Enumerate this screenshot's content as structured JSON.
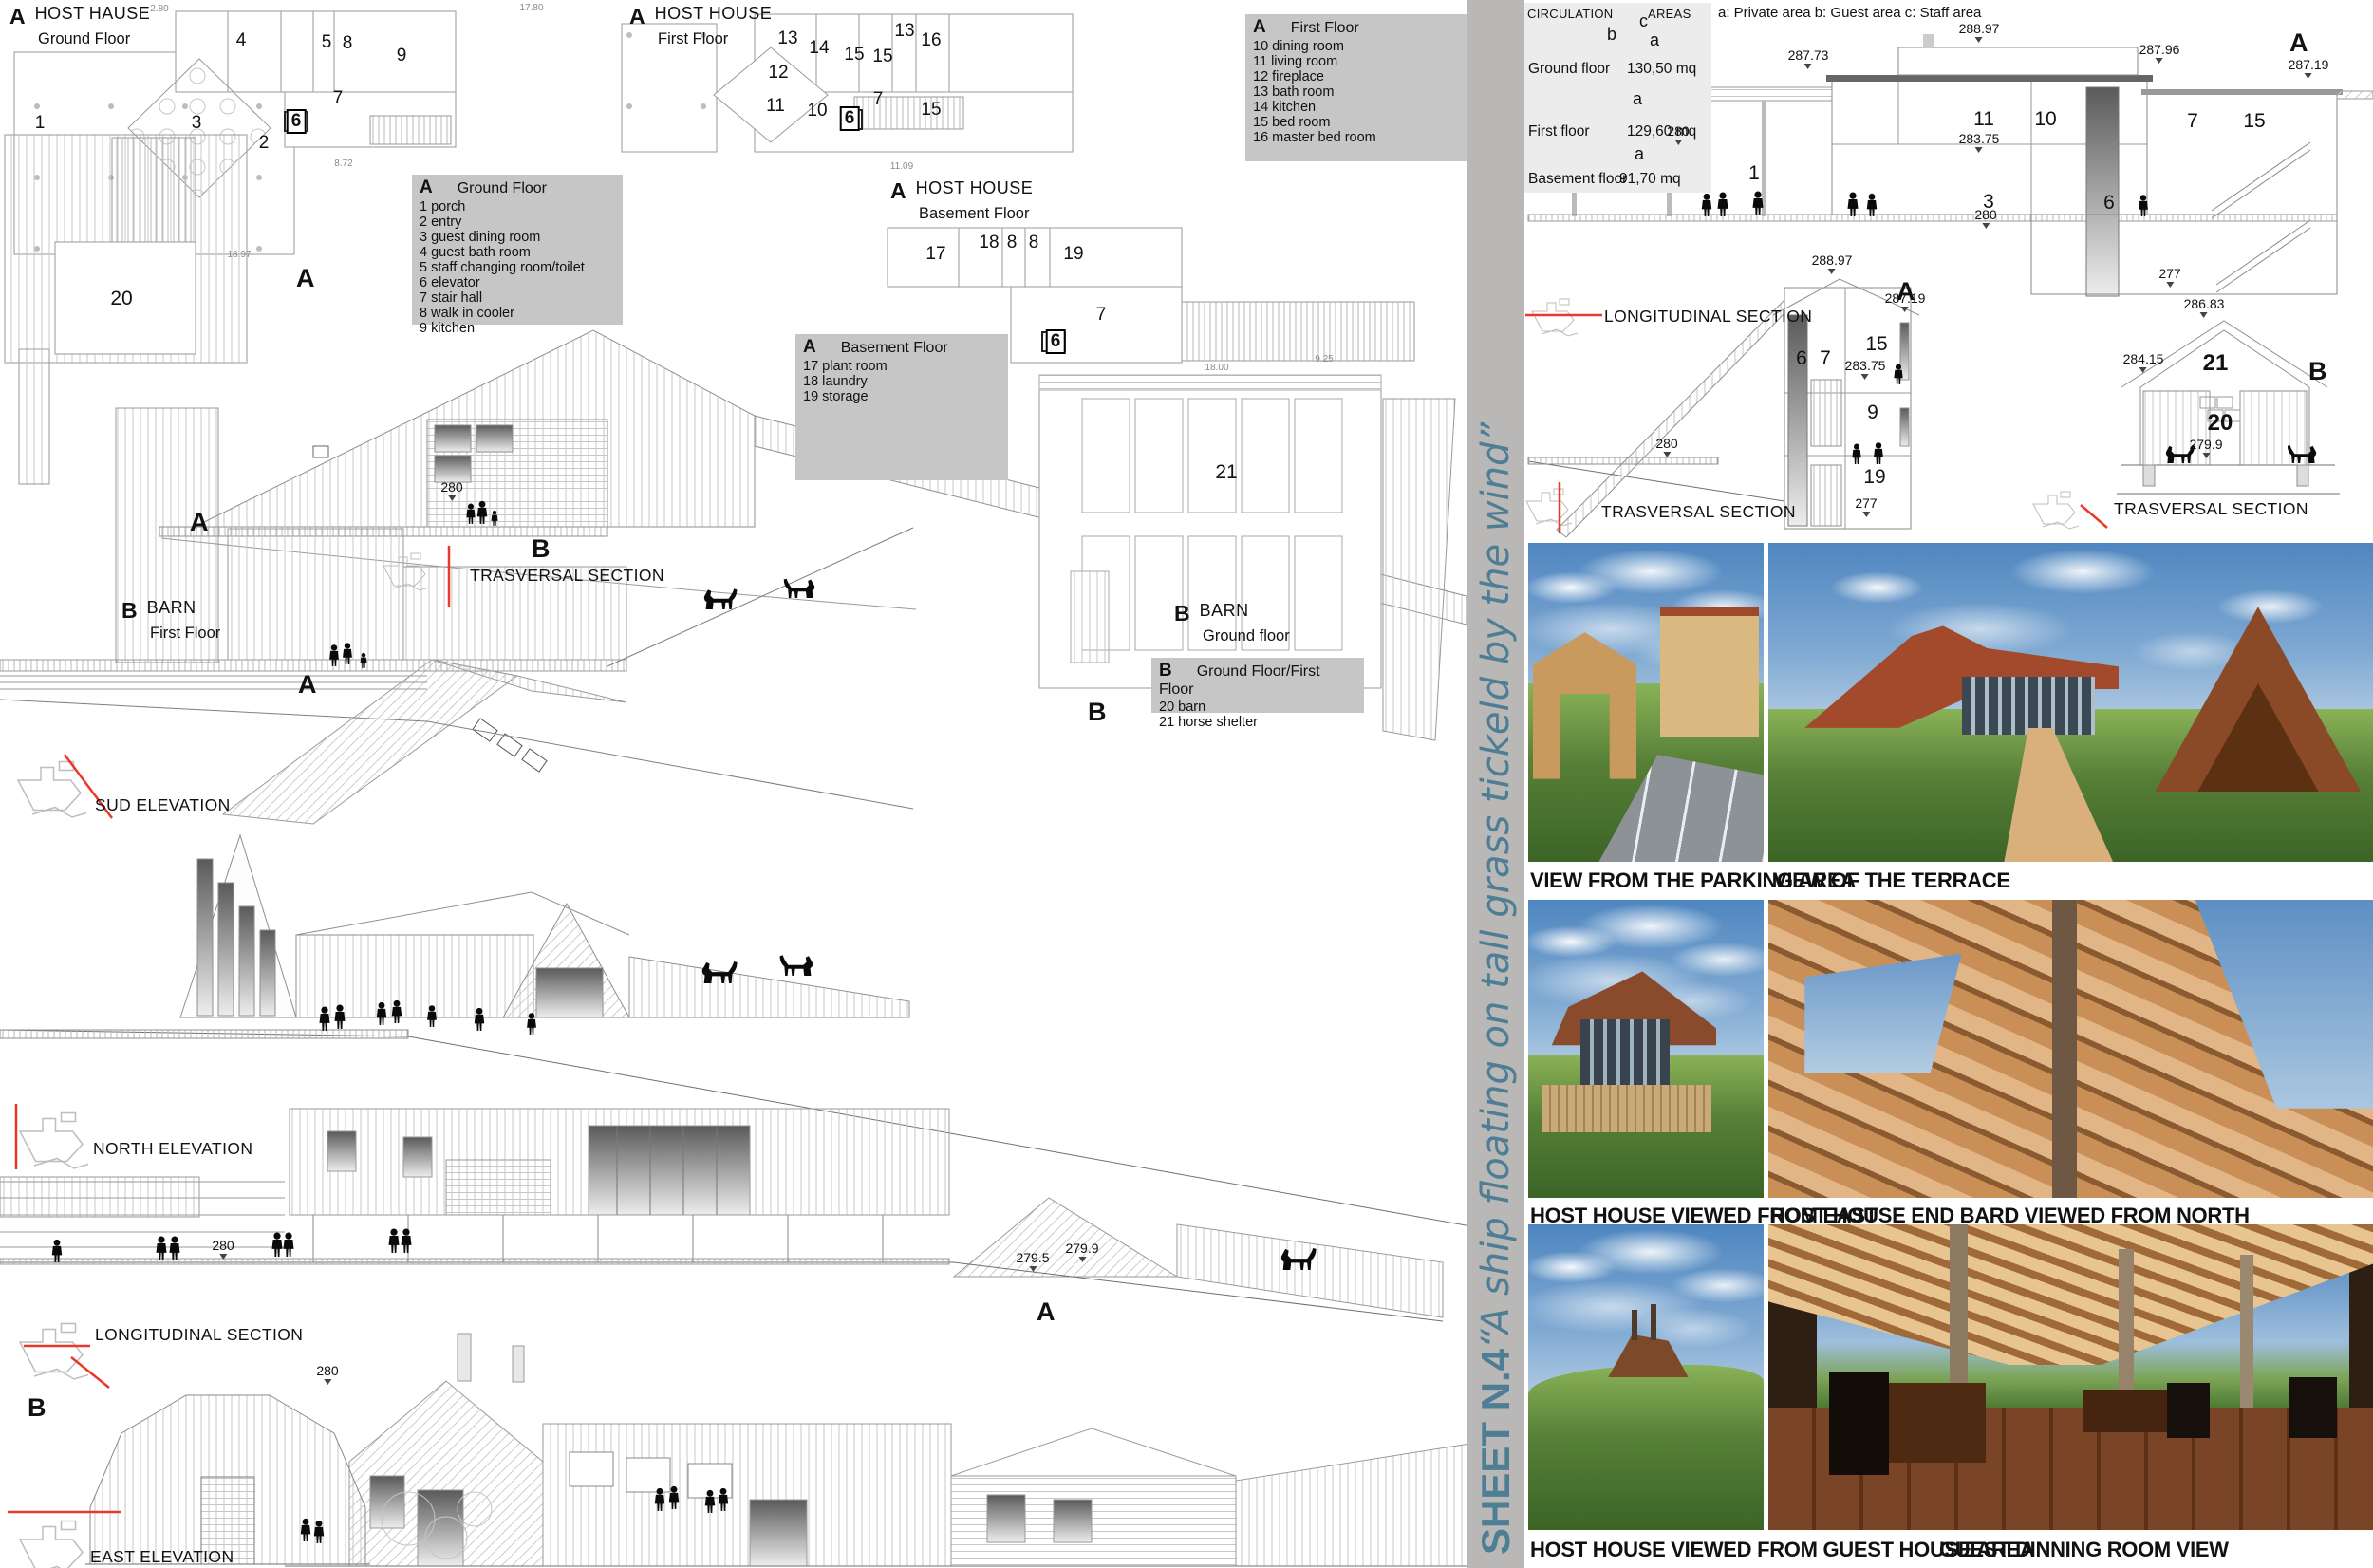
{
  "banner": {
    "sheet_no": "SHEET N.4",
    "quote": "“A ship floating on tall grass tickeld by the wind”"
  },
  "titles": {
    "ground": {
      "marker": "A",
      "name": "HOST HAUSE",
      "floor": "Ground Floor"
    },
    "first": {
      "marker": "A",
      "name": "HOST HOUSE",
      "floor": "First Floor"
    },
    "basement": {
      "marker": "A",
      "name": "HOST HOUSE",
      "floor": "Basement Floor"
    },
    "barn_first": {
      "marker": "B",
      "name": "BARN",
      "floor": "First Floor"
    },
    "barn_ground": {
      "marker": "B",
      "name": "BARN",
      "floor": "Ground floor"
    }
  },
  "legends": {
    "ground": {
      "marker": "A",
      "title": "Ground Floor",
      "items": [
        "1  porch",
        "2 entry",
        "3 guest dining room",
        "4 guest bath room",
        "5 staff changing room/toilet",
        "6 elevator",
        "7 stair hall",
        "8 walk in cooler",
        "9 kitchen"
      ]
    },
    "first": {
      "marker": "A",
      "title": "First Floor",
      "items": [
        "10 dining room",
        "11 living room",
        "12 fireplace",
        "13 bath room",
        "14 kitchen",
        "15 bed room",
        "16 master bed room"
      ]
    },
    "basement": {
      "marker": "A",
      "title": "Basement Floor",
      "items": [
        "17 plant room",
        "18 laundry",
        "19 storage"
      ]
    },
    "barn": {
      "marker": "B",
      "title": "Ground Floor/First Floor",
      "items": [
        "20 barn",
        "21 horse shelter"
      ]
    }
  },
  "areas_panel": {
    "header_circulation": "CIRCULATION",
    "header_areas": "AREAS",
    "zones_note": "a: Private area b: Guest area c: Staff area",
    "rows": [
      {
        "label": "Ground floor",
        "value": "130,50 mq"
      },
      {
        "label": "First floor",
        "value": "129,60 mq"
      },
      {
        "label": "Basement floor",
        "value": "91,70 mq"
      }
    ],
    "letters": [
      "b",
      "c",
      "a",
      "a",
      "a"
    ]
  },
  "section_labels": {
    "trasversal_left": "TRASVERSAL SECTION",
    "sud": "SUD ELEVATION",
    "north": "NORTH ELEVATION",
    "longitudinal_left": "LONGITUDINAL SECTION",
    "east": "EAST ELEVATION",
    "longitudinal_right": "LONGITUDINAL SECTION",
    "trasversal_house": "TRASVERSAL SECTION",
    "trasversal_barn": "TRASVERSAL SECTION"
  },
  "markers": {
    "a": "A",
    "b": "B"
  },
  "rooms": {
    "ground": [
      "1",
      "2",
      "3",
      "4",
      "5",
      "6",
      "7",
      "8",
      "9"
    ],
    "first": [
      "13",
      "14",
      "15",
      "15",
      "13",
      "16",
      "12",
      "11",
      "10",
      "6",
      "7",
      "15"
    ],
    "basement": [
      "17",
      "18",
      "8",
      "8",
      "19",
      "7",
      "6"
    ],
    "barn_first": [
      "20"
    ],
    "barn_ground": [
      "21"
    ],
    "long_right": [
      "11",
      "10",
      "7",
      "15",
      "3",
      "6",
      "1"
    ],
    "transv_house": [
      "6",
      "7",
      "15",
      "9",
      "19"
    ],
    "transv_barn": [
      "21",
      "20"
    ]
  },
  "levels": {
    "long_right": [
      "287.73",
      "288.97",
      "287.96",
      "287.19",
      "283.75",
      "280",
      "277",
      "280"
    ],
    "transv_house": [
      "288.97",
      "287.19",
      "283.75",
      "280",
      "277"
    ],
    "transv_barn": [
      "286.83",
      "284.15",
      "279.9"
    ],
    "left_drawings": [
      "280",
      "280",
      "279.5",
      "279.9",
      "280"
    ]
  },
  "dims": [
    "2.80",
    "17.80",
    "8.72",
    "11.09",
    "18.97",
    "18.00",
    "9.25"
  ],
  "photos": [
    {
      "caption": "VIEW FROM THE PARKING AREA"
    },
    {
      "caption": "VIEW OF THE TERRACE"
    },
    {
      "caption": "HOST HOUSE VIEWED FROM EAST"
    },
    {
      "caption": "HOST HOUSE END BARD VIEWED FROM NORTH"
    },
    {
      "caption": "HOST HOUSE VIEWED FROM GUEST HOUSE AREA"
    },
    {
      "caption": "GUEST DINNING ROOM VIEW"
    }
  ]
}
